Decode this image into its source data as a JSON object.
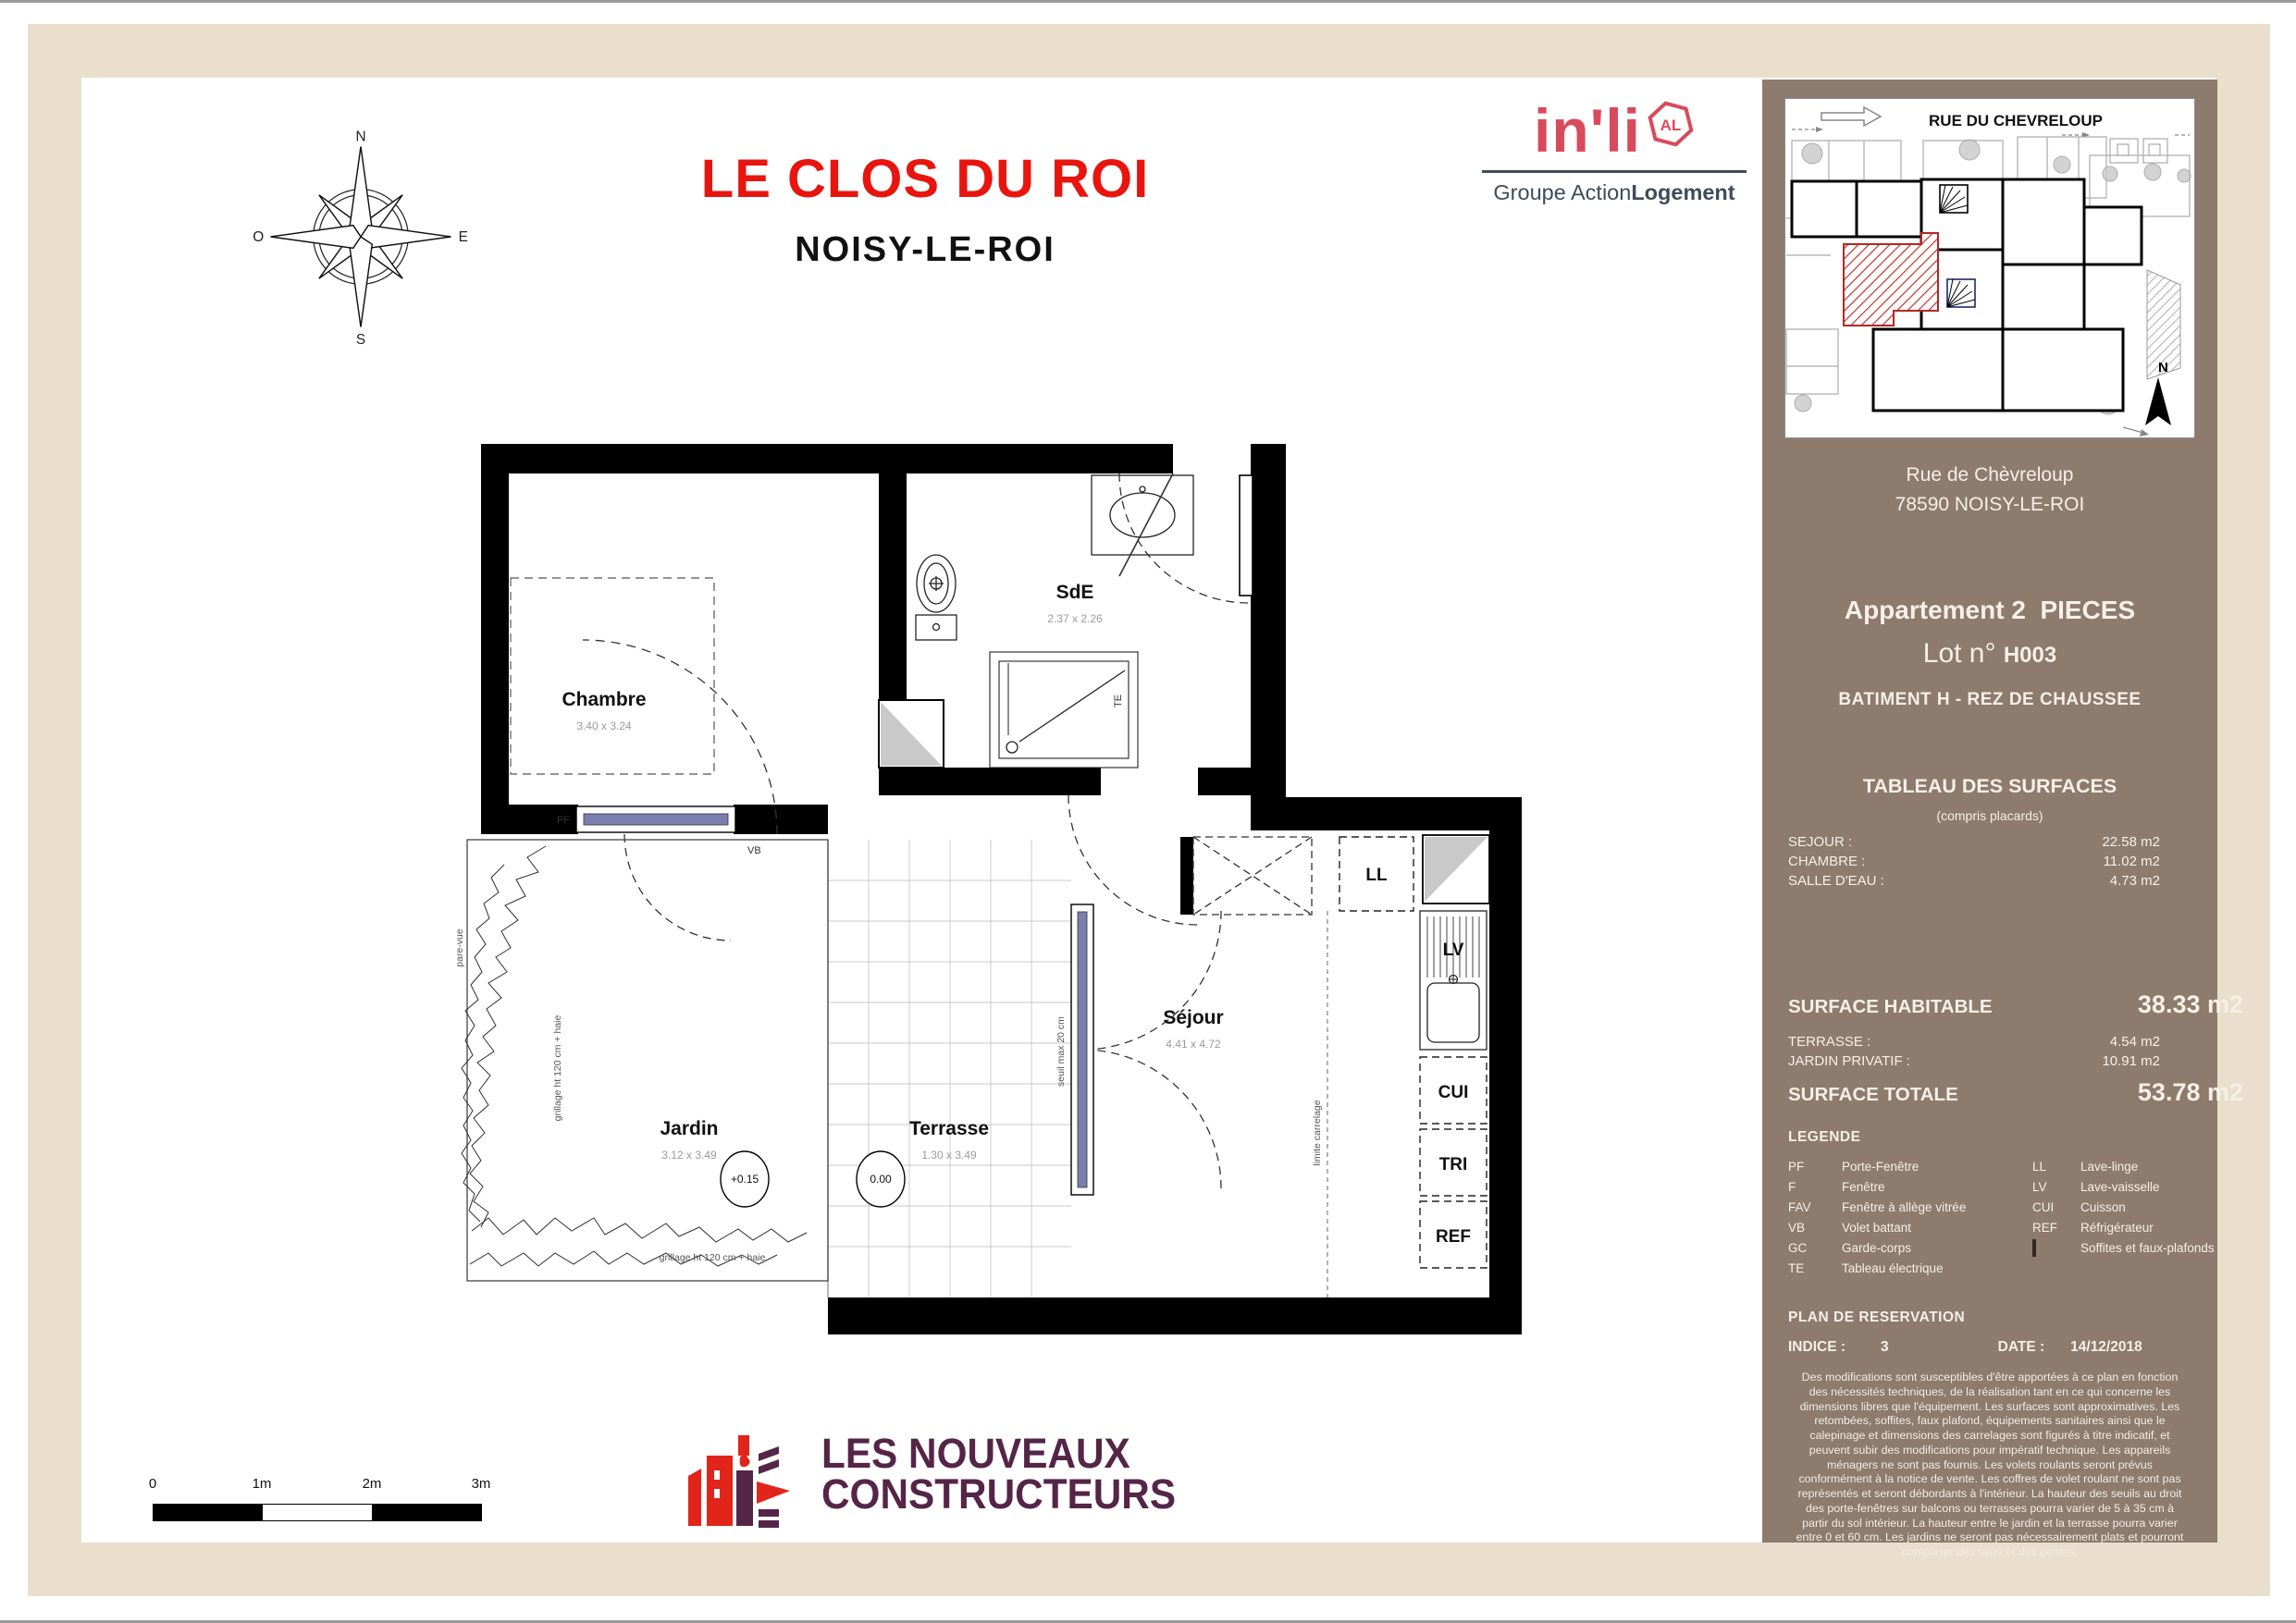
{
  "header": {
    "title": "LE CLOS DU ROI",
    "subtitle": "NOISY-LE-ROI"
  },
  "logo_inli": {
    "name": "in'li",
    "badge": "AL",
    "group_normal": "Groupe Action",
    "group_bold": "Logement",
    "brand_color": "#d84b5c",
    "group_color": "#3f4b5b"
  },
  "compass": {
    "n": "N",
    "e": "E",
    "s": "S",
    "o": "O"
  },
  "site_plan": {
    "street": "RUE DU CHEVRELOUP",
    "north": "N",
    "hatch_color": "#c03330"
  },
  "sidebar": {
    "bg_color": "#8d7b6e",
    "address_line1": "Rue de Chèvreloup",
    "address_line2": "78590 NOISY-LE-ROI",
    "apartment_title": "Appartement 2  PIECES",
    "lot_label": "Lot n°",
    "lot_value": "H003",
    "building": "BATIMENT H - REZ DE CHAUSSEE",
    "surfaces_title": "TABLEAU DES SURFACES",
    "surfaces_subtitle": "(compris placards)",
    "surfaces": [
      {
        "label": "SEJOUR :",
        "value": "22.58 m2"
      },
      {
        "label": "CHAMBRE :",
        "value": "11.02 m2"
      },
      {
        "label": "SALLE D'EAU :",
        "value": "4.73 m2"
      }
    ],
    "surface_habitable_label": "SURFACE HABITABLE",
    "surface_habitable_value": "38.33 m2",
    "extra_surfaces": [
      {
        "label": "TERRASSE :",
        "value": "4.54 m2"
      },
      {
        "label": "JARDIN PRIVATIF :",
        "value": "10.91 m2"
      }
    ],
    "surface_totale_label": "SURFACE TOTALE",
    "surface_totale_value": "53.78 m2",
    "legend_title": "LEGENDE",
    "legend_left": [
      {
        "abbr": "PF",
        "label": "Porte-Fenêtre"
      },
      {
        "abbr": "F",
        "label": "Fenêtre"
      },
      {
        "abbr": "FAV",
        "label": "Fenêtre à allège vitrée"
      },
      {
        "abbr": "VB",
        "label": "Volet battant"
      },
      {
        "abbr": "GC",
        "label": "Garde-corps"
      },
      {
        "abbr": "TE",
        "label": "Tableau électrique"
      }
    ],
    "legend_right": [
      {
        "abbr": "LL",
        "label": "Lave-linge"
      },
      {
        "abbr": "LV",
        "label": "Lave-vaisselle"
      },
      {
        "abbr": "CUI",
        "label": "Cuisson"
      },
      {
        "abbr": "REF",
        "label": "Réfrigérateur"
      }
    ],
    "legend_hatch_label": "Soffites et faux-plafonds",
    "plan_title": "PLAN DE RESERVATION",
    "indice_label": "INDICE :",
    "indice_value": "3",
    "date_label": "DATE :",
    "date_value": "14/12/2018",
    "disclaimer": "Des modifications sont susceptibles d'être apportées à ce plan en fonction des nécessités techniques, de la réalisation tant en ce qui concerne les dimensions libres que l'équipement. Les surfaces sont approximatives. Les retombées, soffites, faux plafond, équipements sanitaires ainsi que le calepinage et dimensions des carrelages sont figurés à titre indicatif, et peuvent subir des modifications pour impératif technique. Les appareils ménagers ne sont pas fournis.  Les volets roulants seront prévus conformément à la notice de vente. Les coffres de volet roulant ne sont pas représentés et seront débordants à l'intérieur. La hauteur des seuils au droit des porte-fenêtres sur balcons ou terrasses pourra varier de 5 à 35 cm à partir du sol intérieur. La hauteur entre le jardin et la terrasse pourra varier entre 0 et 60 cm. Les jardins ne seront pas nécessairement plats et pourront comporter des talus et des pentes."
  },
  "floor_plan": {
    "rooms": [
      {
        "name": "Chambre",
        "dims": "3.40 x 3.24"
      },
      {
        "name": "SdE",
        "dims": "2.37 x 2.26"
      },
      {
        "name": "Séjour",
        "dims": "4.41 x 4.72"
      },
      {
        "name": "Jardin",
        "dims": "3.12 x 3.49"
      },
      {
        "name": "Terrasse",
        "dims": "1.30 x 3.49"
      }
    ],
    "appliances": [
      "LL",
      "LV",
      "CUI",
      "TRI",
      "REF"
    ],
    "labels": {
      "pf": "PF",
      "vb": "VB",
      "te": "TE",
      "pare_vue": "pare-vue",
      "seuil": "seuil max 20 cm",
      "limite": "limite carrelage",
      "grillage_left": "grillage ht 120 cm + haie",
      "grillage_bottom": "grillage ht 120 cm + haie",
      "level_jardin": "+0.15",
      "level_terrasse": "0.00"
    },
    "window_color": "#7b7fad"
  },
  "scale_bar": {
    "labels": [
      "0",
      "1m",
      "2m",
      "3m"
    ]
  },
  "logo_lnc": {
    "line1": "LES NOUVEAUX",
    "line2": "CONSTRUCTEURS",
    "color": "#552548",
    "red": "#e1251b"
  }
}
